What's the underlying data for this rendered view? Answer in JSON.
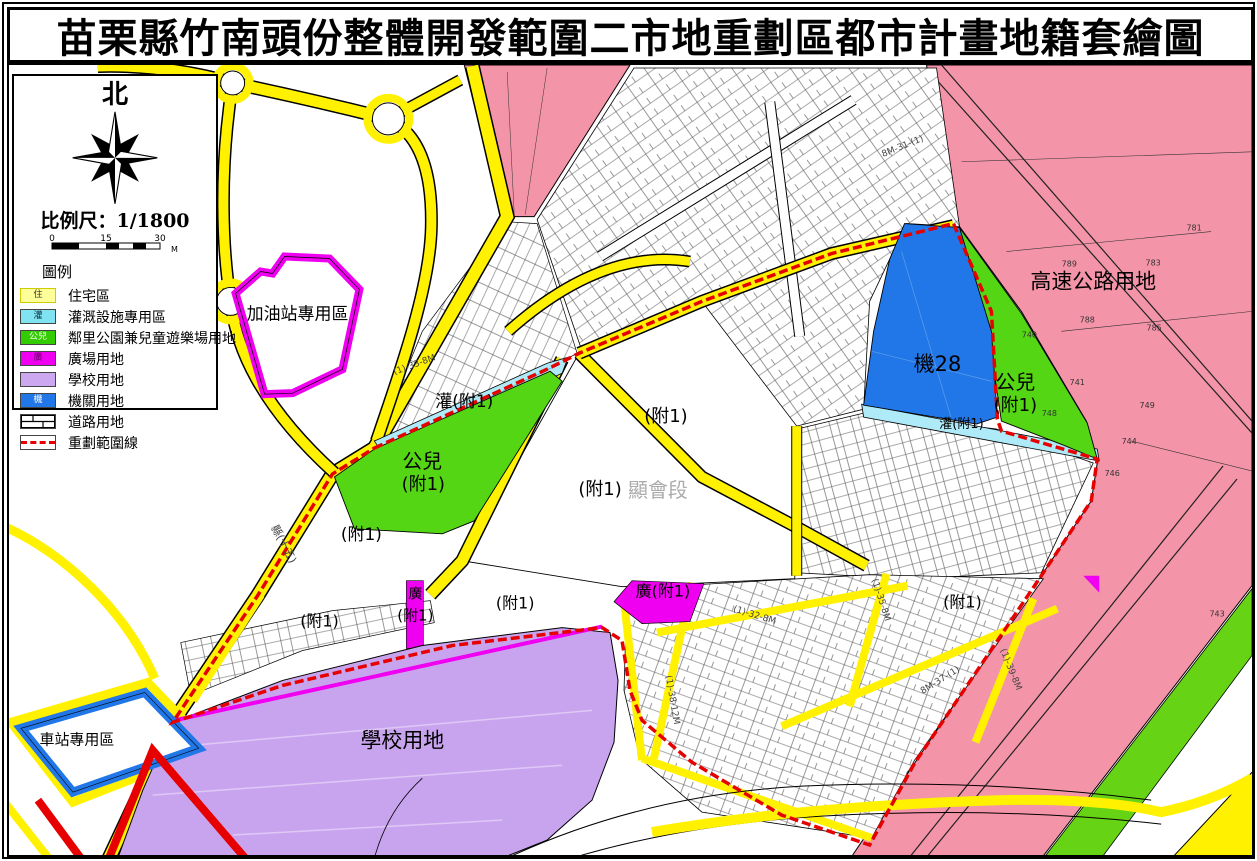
{
  "title": "苗栗縣竹南頭份整體開發範圍二市地重劃區都市計畫地籍套繪圖",
  "compass": {
    "north_label": "北"
  },
  "scale": {
    "label": "比例尺：1/1800",
    "tick0": "0",
    "tick1": "15",
    "tick2": "30",
    "unit": "M"
  },
  "legend": {
    "title": "圖例",
    "items": [
      {
        "code": "住",
        "label": "住宅區",
        "color": "#FFFF99"
      },
      {
        "code": "灌",
        "label": "灌溉設施專用區",
        "color": "#7FE3F2"
      },
      {
        "code": "公兒",
        "label": "鄰里公園兼兒童遊樂場用地",
        "color": "#33CC00"
      },
      {
        "code": "廣",
        "label": "廣場用地",
        "color": "#F000F0"
      },
      {
        "code": "",
        "label": "學校用地",
        "color": "#CCA8F0"
      },
      {
        "code": "機",
        "label": "機關用地",
        "color": "#2277E8"
      },
      {
        "code": "",
        "label": "道路用地",
        "color": "road-pattern"
      },
      {
        "code": "",
        "label": "重劃範圍線",
        "color": "red-dash"
      }
    ]
  },
  "map": {
    "colors": {
      "road_yellow": "#FFF100",
      "highway_pink": "#F494A8",
      "park_green": "#55D614",
      "irrigation_cyan": "#AEEAF8",
      "plaza_magenta": "#F000F0",
      "school_purple": "#C9A4EE",
      "agency_blue": "#2277E8",
      "boundary_red": "#E60000"
    },
    "zone_labels": [
      {
        "text": "加油站專用區"
      },
      {
        "text": "高速公路用地"
      },
      {
        "text": "機28"
      },
      {
        "text": "公兒"
      },
      {
        "text": "(附1)"
      },
      {
        "text": "灌(附1)"
      },
      {
        "text": "灌(附1)"
      },
      {
        "text": "公兒"
      },
      {
        "text": "(附1)"
      },
      {
        "text": "(附1)"
      },
      {
        "text": "(附1)"
      },
      {
        "text": "顯會段"
      },
      {
        "text": "(附1)"
      },
      {
        "text": "(附1)"
      },
      {
        "text": "廣"
      },
      {
        "text": "(附1)"
      },
      {
        "text": "(附1)"
      },
      {
        "text": "廣(附1)"
      },
      {
        "text": "(附1)"
      },
      {
        "text": "學校用地"
      },
      {
        "text": "車站專用區"
      }
    ],
    "road_labels": [
      {
        "text": "8M-31-(1)"
      },
      {
        "text": "(1)-33-8M"
      },
      {
        "text": "(1)-32-8M"
      },
      {
        "text": "(1)-35-8M"
      },
      {
        "text": "8M-37-(1)"
      },
      {
        "text": "(1)-39-8M"
      },
      {
        "text": "(1)-38-12M"
      },
      {
        "text": "縣(十五)"
      }
    ],
    "parcel_numbers": [
      {
        "text": "781"
      },
      {
        "text": "789"
      },
      {
        "text": "783"
      },
      {
        "text": "788"
      },
      {
        "text": "785"
      },
      {
        "text": "741"
      },
      {
        "text": "749"
      },
      {
        "text": "744"
      },
      {
        "text": "746"
      },
      {
        "text": "743"
      },
      {
        "text": "740"
      },
      {
        "text": "748"
      }
    ]
  }
}
